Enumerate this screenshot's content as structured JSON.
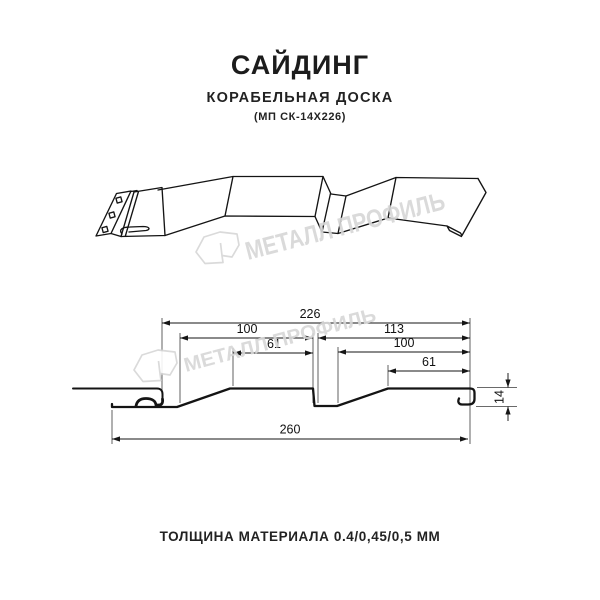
{
  "page": {
    "background": "#ffffff"
  },
  "header": {
    "title": "САЙДИНГ",
    "subtitle": "КОРАБЕЛЬНАЯ ДОСКА",
    "model_code": "(МП СК-14Х226)"
  },
  "watermark": {
    "brand_text": "МЕТАЛЛ ПРОФИЛЬ",
    "color": "#d7d7d7"
  },
  "drawing": {
    "line_color": "#141414",
    "dimension_color": "#161616",
    "dimensions": {
      "overall_width": "260",
      "coverage_width": "226",
      "left_board_width": "100",
      "left_board_flat": "61",
      "right_span": "113",
      "right_board_width": "100",
      "right_board_flat": "61",
      "profile_height": "14"
    }
  },
  "footer": {
    "material_thickness": "ТОЛЩИНА МАТЕРИАЛА 0.4/0,45/0,5 ММ"
  }
}
